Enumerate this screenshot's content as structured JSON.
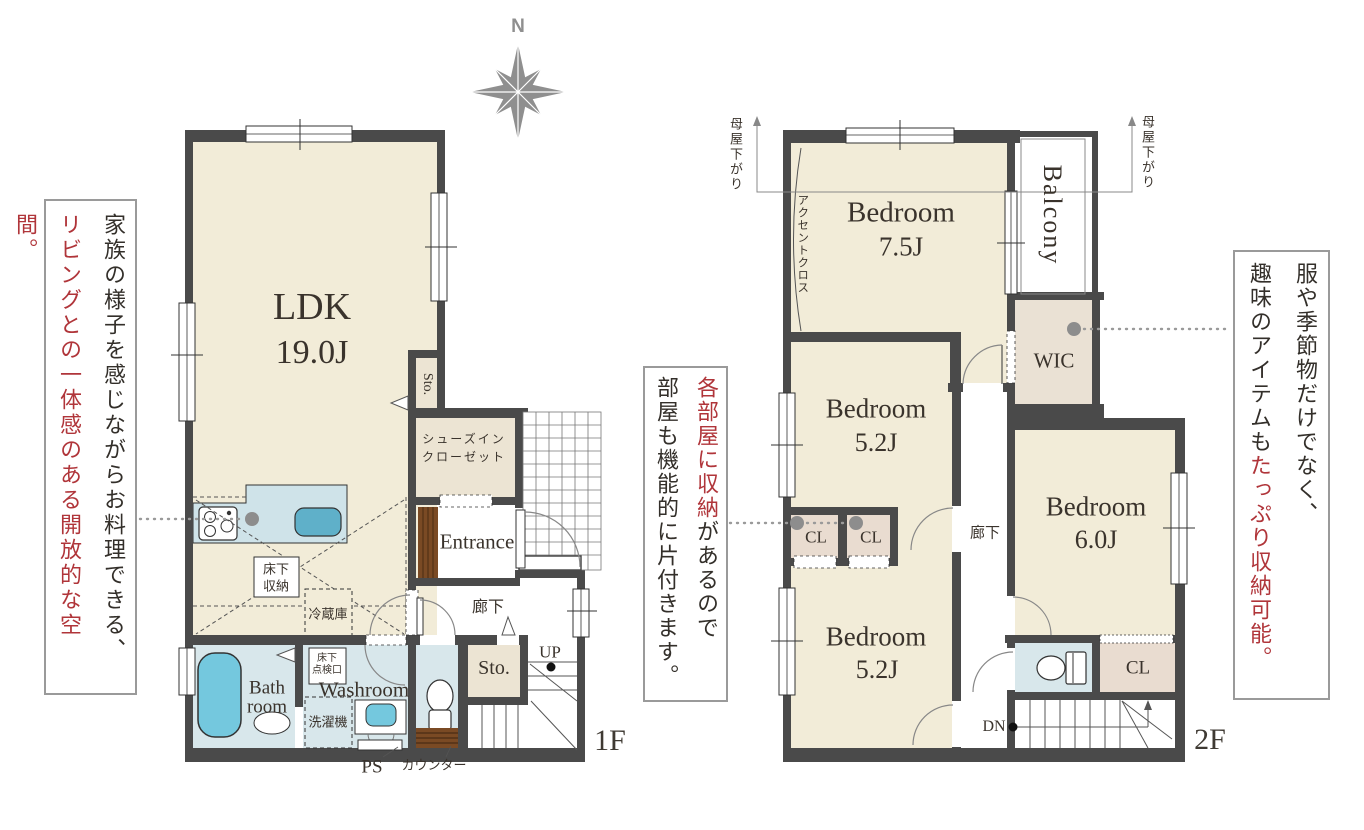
{
  "palette": {
    "wall": "#4a4a4a",
    "room_cream": "#f2ecd8",
    "closet_beige": "#ece4d3",
    "closet_pink": "#e9dcd0",
    "wet_blue": "#d8e7eb",
    "fixture_cyan": "#74c8de",
    "kitchen_counter": "#cfe3e9",
    "wood_brown": "#7a4a24",
    "accent_red": "#b0353a",
    "leader_gray": "#8d8d8d",
    "compass_gray": "#8f8f8f"
  },
  "compass": {
    "north_label": "N"
  },
  "floor1": {
    "floor_label": "1F",
    "rooms": {
      "ldk": {
        "name": "LDK",
        "area": "19.0J"
      },
      "sto_nook": "Sto.",
      "shoes_closet_line1": "シューズイン",
      "shoes_closet_line2": "クローゼット",
      "entrance": "Entrance",
      "hallway": "廊下",
      "storage": "Sto.",
      "up": "UP",
      "bath_line1": "Bath",
      "bath_line2": "room",
      "washroom": "Washroom",
      "inspection_line1": "床下",
      "inspection_line2": "点検口",
      "washer": "洗濯機",
      "underfloor_line1": "床下",
      "underfloor_line2": "収納",
      "fridge": "冷蔵庫",
      "ps": "PS",
      "toilet_counter": "カウンター"
    }
  },
  "floor2": {
    "floor_label": "2F",
    "rooms": {
      "bedroom1": {
        "name": "Bedroom",
        "area": "7.5J"
      },
      "bedroom2": {
        "name": "Bedroom",
        "area": "5.2J"
      },
      "bedroom3": {
        "name": "Bedroom",
        "area": "6.0J"
      },
      "bedroom4": {
        "name": "Bedroom",
        "area": "5.2J"
      },
      "balcony": "Balcony",
      "accent_cloth": "アクセントクロス",
      "wic": "WIC",
      "cl1": "CL",
      "cl2": "CL",
      "cl3": "CL",
      "hallway": "廊下",
      "dn": "DN",
      "eaves_left": "母屋下がり",
      "eaves_right": "母屋下がり"
    }
  },
  "annotations": {
    "left": {
      "line1": "家族の様子を感じながらお料理できる、",
      "line2_red": "リビングとの一体感のある開放的な空間。"
    },
    "middle": {
      "line1_red": "各部屋に収納",
      "line1_rest": "があるので",
      "line2": "部屋も機能的に片付きます。"
    },
    "right": {
      "line1": "服や季節物だけでなく、",
      "line2_start": "趣味のアイテムも",
      "line2_red": "たっぷり収納可能。"
    }
  }
}
